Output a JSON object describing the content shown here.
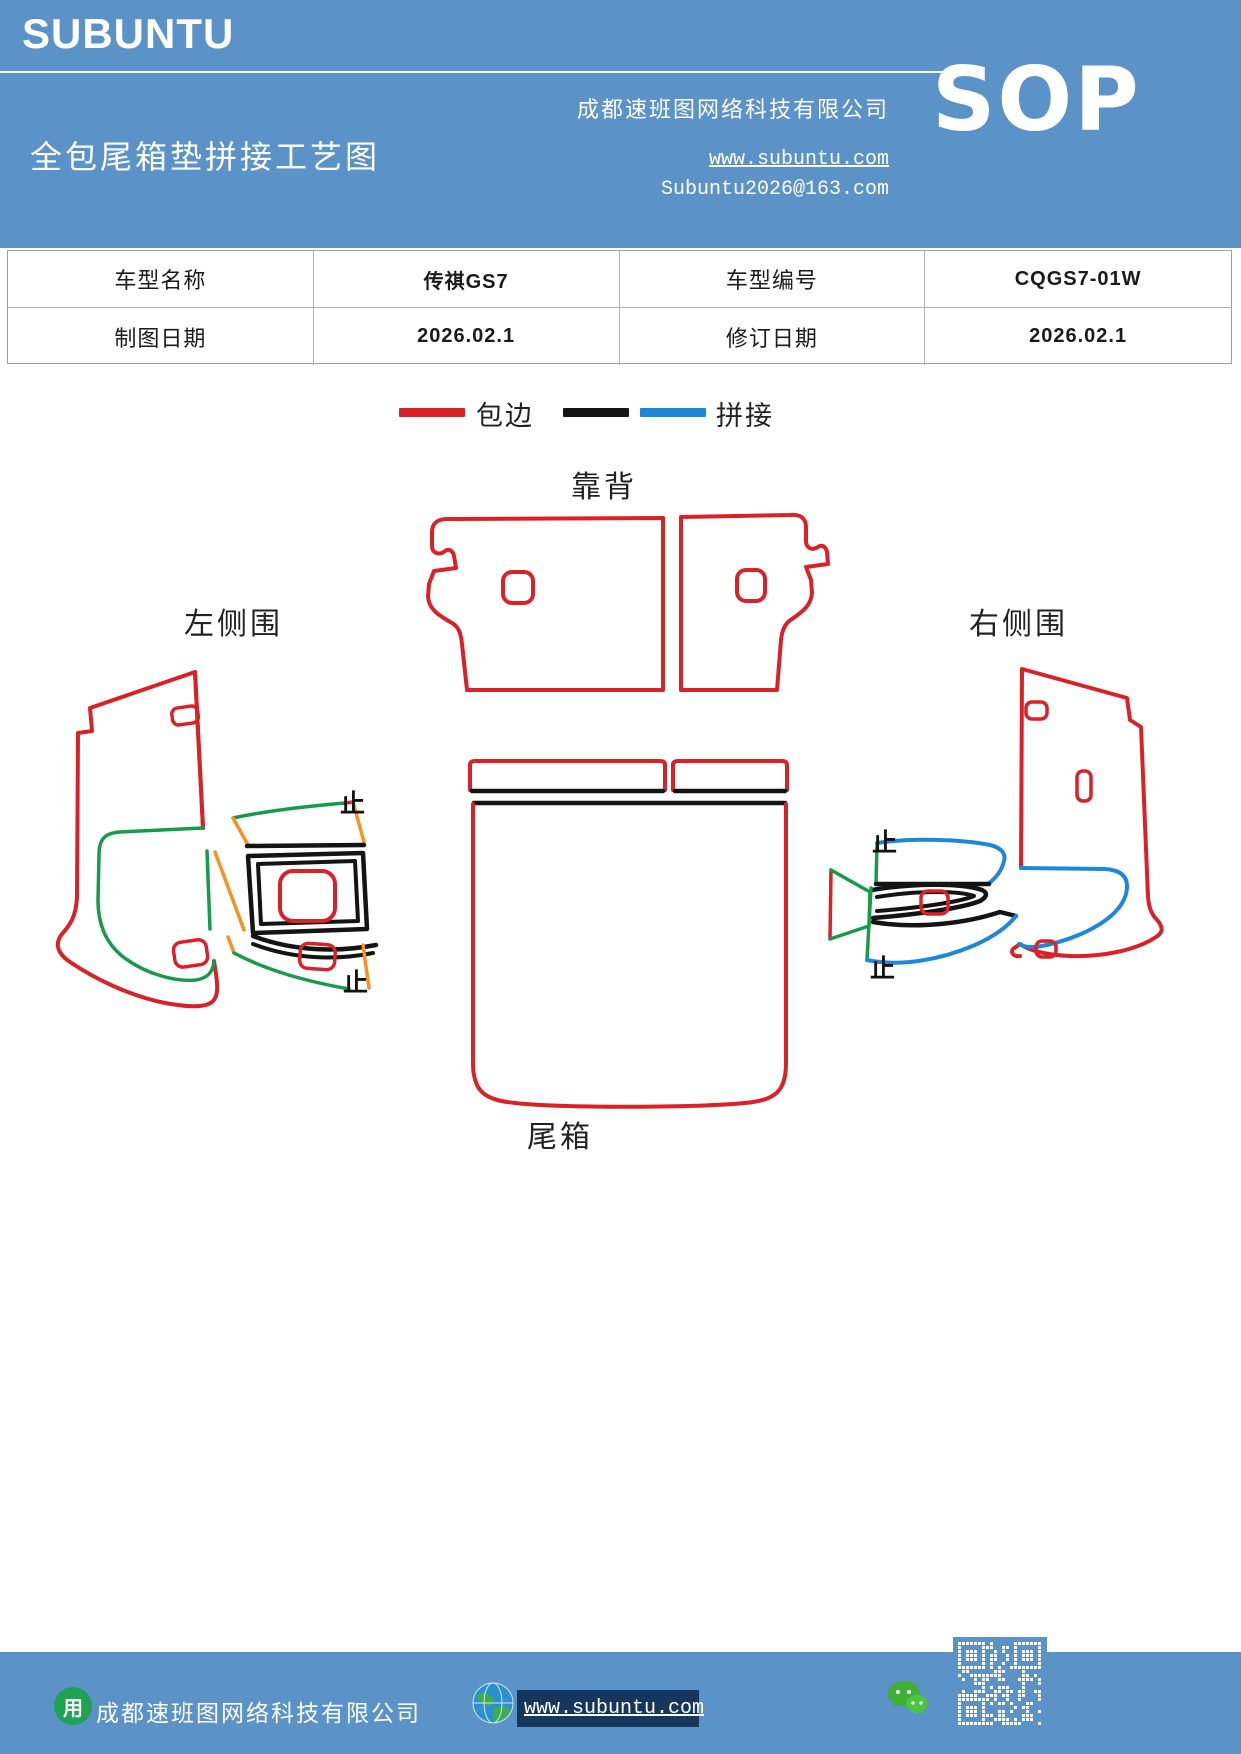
{
  "header": {
    "logo": "SUBUNTU",
    "company": "成都速班图网络科技有限公司",
    "title": "全包尾箱垫拼接工艺图",
    "sop_label": "SOP",
    "website": "www.subuntu.com",
    "email": "Subuntu2026@163.com"
  },
  "info_table": {
    "rows": [
      [
        "车型名称",
        "传祺GS7",
        "车型编号",
        "CQGS7-01W"
      ],
      [
        "制图日期",
        "2026.02.1",
        "修订日期",
        "2026.02.1"
      ]
    ]
  },
  "legend": {
    "edge_label": "包边",
    "splice_label": "拼接"
  },
  "diagram": {
    "backrest_label": "靠背",
    "left_side_label": "左侧围",
    "right_side_label": "右侧围",
    "trunk_label": "尾箱",
    "stop_mark": "止"
  },
  "colors": {
    "theme_blue": "#5b92c7",
    "edge_red": "#da2128",
    "splice_black": "#141414",
    "splice_blue": "#1f87d8",
    "splice_green": "#189a4b",
    "splice_orange": "#f6921e",
    "link_bar_navy": "#17365d",
    "wechat_green": "#3eb135"
  },
  "footer": {
    "company": "成都速班图网络科技有限公司",
    "website": "www.subuntu.com"
  }
}
